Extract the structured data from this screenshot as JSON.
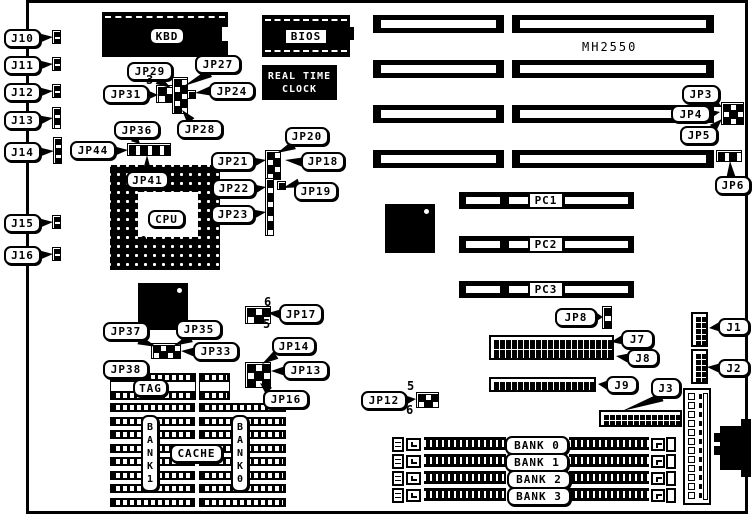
{
  "board_model": "MH2550",
  "colors": {
    "ink": "#000000",
    "paper": "#ffffff"
  },
  "board": {
    "x": 26,
    "y": 0,
    "w": 722,
    "h": 514,
    "border": 3
  },
  "chips": [
    {
      "id": "kbd-chip",
      "x": 102,
      "y": 12,
      "w": 126,
      "h": 45,
      "dash_top": true,
      "notch": [
        222,
        27,
        6,
        14
      ]
    },
    {
      "id": "bios-chip",
      "x": 262,
      "y": 15,
      "w": 88,
      "h": 42,
      "dash_top": true,
      "dash_bottom": true,
      "tab": [
        349,
        27,
        5,
        13
      ]
    },
    {
      "id": "rtc-chip",
      "x": 262,
      "y": 65,
      "w": 75,
      "h": 35,
      "text": [
        "REAL TIME",
        "CLOCK"
      ]
    },
    {
      "id": "chipset-chip",
      "x": 385,
      "y": 204,
      "w": 50,
      "h": 49,
      "dot": [
        424,
        209
      ]
    },
    {
      "id": "cache-ctrl-chip",
      "x": 138,
      "y": 283,
      "w": 50,
      "h": 47,
      "dot": [
        177,
        288
      ]
    }
  ],
  "cpu": {
    "x": 110,
    "y": 165,
    "w": 110,
    "h": 105,
    "inner": [
      138,
      192,
      60,
      45
    ],
    "dot": [
      141,
      236
    ]
  },
  "isa": {
    "rows": [
      15,
      60,
      105,
      150
    ],
    "h": 18,
    "segs": [
      [
        373,
        131
      ],
      [
        512,
        202
      ]
    ]
  },
  "pci": {
    "rows": [
      192,
      236,
      281
    ],
    "x": 459,
    "w": 175,
    "h": 17,
    "stripes": [
      [
        466,
        34
      ],
      [
        509,
        20
      ],
      [
        565,
        63
      ]
    ]
  },
  "simm": {
    "rows": [
      436,
      453,
      470,
      487
    ],
    "bracket_left": [
      392,
      12,
      15
    ],
    "clip_left": [
      406,
      15,
      13
    ],
    "bar1": [
      424,
      82
    ],
    "bar2": [
      569,
      80
    ],
    "clip_right": [
      651,
      14,
      13
    ],
    "bracket_right": [
      666,
      10,
      15
    ]
  },
  "cache": {
    "tag_y": 373,
    "tag_h": 27,
    "tag_pieces": [
      [
        110,
        86
      ],
      [
        199,
        31
      ]
    ],
    "cols": [
      [
        110,
        85
      ],
      [
        199,
        87
      ]
    ],
    "chip_ys": [
      403,
      430,
      457,
      484
    ]
  },
  "pinblocks": [
    {
      "id": "kbd-jumper-left",
      "x": 156,
      "y": 85,
      "cols": 2,
      "rows": 2,
      "cw": 8,
      "ch": 8
    },
    {
      "id": "kbd-jumper-mid",
      "x": 172,
      "y": 77,
      "cols": 2,
      "rows": 5,
      "cw": 7,
      "ch": 7
    },
    {
      "id": "kbd-jumper-nub",
      "x": 187,
      "y": 90,
      "cols": 1,
      "rows": 1,
      "cw": 7,
      "ch": 7
    },
    {
      "id": "jp36-strip",
      "x": 127,
      "y": 143,
      "cols": 7,
      "rows": 1,
      "cw": 6,
      "ch": 11
    },
    {
      "id": "jp18-23-strip-top",
      "x": 265,
      "y": 150,
      "cols": 2,
      "rows": 4,
      "cw": 7,
      "ch": 7
    },
    {
      "id": "jp18-23-strip-bottom",
      "x": 265,
      "y": 178,
      "cols": 1,
      "rows": 8,
      "cw": 7,
      "ch": 7
    },
    {
      "id": "jp19-pin",
      "x": 277,
      "y": 181,
      "cols": 1,
      "rows": 1,
      "cw": 7,
      "ch": 7
    },
    {
      "id": "jp3-5-block",
      "x": 721,
      "y": 102,
      "cols": 3,
      "rows": 3,
      "cw": 7,
      "ch": 7
    },
    {
      "id": "jp6-block",
      "x": 716,
      "y": 150,
      "cols": 4,
      "rows": 1,
      "cw": 6,
      "ch": 10
    },
    {
      "id": "jp8-block",
      "x": 602,
      "y": 306,
      "cols": 1,
      "rows": 3,
      "cw": 8,
      "ch": 7
    },
    {
      "id": "jp17-block",
      "x": 245,
      "y": 306,
      "cols": 3,
      "rows": 2,
      "cw": 8,
      "ch": 8
    },
    {
      "id": "jp13-16-block",
      "x": 245,
      "y": 362,
      "cols": 3,
      "rows": 3,
      "cw": 8,
      "ch": 8
    },
    {
      "id": "jp33-block",
      "x": 151,
      "y": 343,
      "cols": 4,
      "rows": 2,
      "cw": 7,
      "ch": 7
    },
    {
      "id": "jp12-block",
      "x": 416,
      "y": 392,
      "cols": 3,
      "rows": 2,
      "cw": 7,
      "ch": 7
    },
    {
      "id": "j10-conn",
      "x": 52,
      "y": 30,
      "cols": 1,
      "rows": 3,
      "cw": 7,
      "ch": 4
    },
    {
      "id": "j11-conn",
      "x": 52,
      "y": 57,
      "cols": 1,
      "rows": 3,
      "cw": 7,
      "ch": 4
    },
    {
      "id": "j12-conn",
      "x": 52,
      "y": 84,
      "cols": 1,
      "rows": 3,
      "cw": 7,
      "ch": 4
    },
    {
      "id": "j13-conn",
      "x": 52,
      "y": 107,
      "cols": 1,
      "rows": 4,
      "cw": 7,
      "ch": 5
    },
    {
      "id": "j14-conn",
      "x": 53,
      "y": 137,
      "cols": 1,
      "rows": 5,
      "cw": 7,
      "ch": 5
    },
    {
      "id": "j15-conn",
      "x": 52,
      "y": 215,
      "cols": 1,
      "rows": 3,
      "cw": 7,
      "ch": 4
    },
    {
      "id": "j16-conn",
      "x": 52,
      "y": 247,
      "cols": 1,
      "rows": 3,
      "cw": 7,
      "ch": 4
    }
  ],
  "headers": [
    {
      "id": "j7-j8-header",
      "x": 489,
      "y": 335,
      "cols": 20,
      "rows": 2,
      "cw": 5,
      "ch": 9,
      "gap": 1
    },
    {
      "id": "j9-header",
      "x": 489,
      "y": 377,
      "cols": 17,
      "rows": 1,
      "cw": 5,
      "ch": 9,
      "gap": 1
    },
    {
      "id": "j3-header",
      "x": 599,
      "y": 410,
      "cols": 13,
      "rows": 2,
      "cw": 5,
      "ch": 5,
      "gap": 1
    },
    {
      "id": "j1-header",
      "x": 691,
      "y": 312,
      "cols": 2,
      "rows": 5,
      "cw": 5,
      "ch": 5,
      "gap": 1
    },
    {
      "id": "j2-header",
      "x": 691,
      "y": 349,
      "cols": 2,
      "rows": 5,
      "cw": 5,
      "ch": 5,
      "gap": 1
    }
  ],
  "power": {
    "x": 683,
    "y": 388,
    "w": 28,
    "h": 117,
    "pins": 12
  },
  "din": [
    [
      714,
      433,
      8,
      9
    ],
    [
      714,
      446,
      8,
      9
    ],
    [
      720,
      426,
      28,
      44
    ],
    [
      741,
      419,
      10,
      58
    ]
  ],
  "callouts": [
    {
      "id": "j10",
      "label": "J10",
      "x": 4,
      "y": 29,
      "w": 37,
      "h": 19,
      "tail": {
        "from": [
          40,
          38
        ],
        "to": [
          53,
          37
        ]
      }
    },
    {
      "id": "j11",
      "label": "J11",
      "x": 4,
      "y": 56,
      "w": 37,
      "h": 19,
      "tail": {
        "from": [
          40,
          65
        ],
        "to": [
          53,
          64
        ]
      }
    },
    {
      "id": "j12",
      "label": "J12",
      "x": 4,
      "y": 83,
      "w": 37,
      "h": 19,
      "tail": {
        "from": [
          40,
          92
        ],
        "to": [
          53,
          91
        ]
      }
    },
    {
      "id": "j13",
      "label": "J13",
      "x": 4,
      "y": 111,
      "w": 37,
      "h": 19,
      "tail": {
        "from": [
          40,
          120
        ],
        "to": [
          53,
          118
        ]
      }
    },
    {
      "id": "j14",
      "label": "J14",
      "x": 4,
      "y": 142,
      "w": 37,
      "h": 20,
      "tail": {
        "from": [
          40,
          152
        ],
        "to": [
          54,
          151
        ]
      }
    },
    {
      "id": "j15",
      "label": "J15",
      "x": 4,
      "y": 214,
      "w": 37,
      "h": 19,
      "tail": {
        "from": [
          40,
          223
        ],
        "to": [
          53,
          222
        ]
      }
    },
    {
      "id": "j16",
      "label": "J16",
      "x": 4,
      "y": 246,
      "w": 37,
      "h": 19,
      "tail": {
        "from": [
          40,
          255
        ],
        "to": [
          53,
          254
        ]
      }
    },
    {
      "id": "jp29",
      "label": "JP29",
      "x": 127,
      "y": 62,
      "w": 46,
      "h": 19,
      "tail": {
        "from": [
          158,
          80
        ],
        "to": [
          171,
          88
        ]
      }
    },
    {
      "id": "jp27",
      "label": "JP27",
      "x": 195,
      "y": 55,
      "w": 46,
      "h": 19,
      "tail": {
        "from": [
          210,
          73
        ],
        "to": [
          184,
          86
        ]
      }
    },
    {
      "id": "jp24",
      "label": "JP24",
      "x": 209,
      "y": 82,
      "w": 46,
      "h": 18,
      "tail": {
        "from": [
          210,
          91
        ],
        "to": [
          195,
          93
        ]
      }
    },
    {
      "id": "jp31",
      "label": "JP31",
      "x": 103,
      "y": 85,
      "w": 46,
      "h": 19,
      "tail": {
        "from": [
          148,
          95
        ],
        "to": [
          158,
          95
        ]
      }
    },
    {
      "id": "jp28",
      "label": "JP28",
      "x": 177,
      "y": 120,
      "w": 46,
      "h": 19,
      "tail": {
        "from": [
          191,
          121
        ],
        "to": [
          182,
          110
        ]
      }
    },
    {
      "id": "jp36",
      "label": "JP36",
      "x": 114,
      "y": 121,
      "w": 46,
      "h": 18,
      "tail": {
        "from": [
          134,
          138
        ],
        "to": [
          140,
          144
        ]
      }
    },
    {
      "id": "jp44",
      "label": "JP44",
      "x": 70,
      "y": 141,
      "w": 46,
      "h": 19,
      "tail": {
        "from": [
          115,
          151
        ],
        "to": [
          128,
          150
        ]
      }
    },
    {
      "id": "jp41",
      "label": "JP41",
      "x": 126,
      "y": 171,
      "w": 43,
      "h": 18,
      "tail": {
        "from": [
          147,
          172
        ],
        "to": [
          147,
          155
        ]
      }
    },
    {
      "id": "jp20",
      "label": "JP20",
      "x": 285,
      "y": 127,
      "w": 44,
      "h": 19,
      "tail": {
        "from": [
          294,
          145
        ],
        "to": [
          277,
          153
        ]
      }
    },
    {
      "id": "jp21",
      "label": "JP21",
      "x": 211,
      "y": 152,
      "w": 44,
      "h": 19,
      "tail": {
        "from": [
          254,
          162
        ],
        "to": [
          266,
          160
        ]
      }
    },
    {
      "id": "jp18",
      "label": "JP18",
      "x": 301,
      "y": 152,
      "w": 44,
      "h": 19,
      "tail": {
        "from": [
          302,
          162
        ],
        "to": [
          285,
          160
        ]
      }
    },
    {
      "id": "jp22",
      "label": "JP22",
      "x": 212,
      "y": 179,
      "w": 44,
      "h": 19,
      "tail": {
        "from": [
          255,
          189
        ],
        "to": [
          266,
          187
        ]
      }
    },
    {
      "id": "jp19",
      "label": "JP19",
      "x": 294,
      "y": 182,
      "w": 44,
      "h": 19,
      "tail": {
        "from": [
          299,
          183
        ],
        "to": [
          283,
          188
        ]
      }
    },
    {
      "id": "jp23",
      "label": "JP23",
      "x": 211,
      "y": 205,
      "w": 44,
      "h": 19,
      "tail": {
        "from": [
          254,
          214
        ],
        "to": [
          266,
          212
        ]
      }
    },
    {
      "id": "jp3",
      "label": "JP3",
      "x": 682,
      "y": 85,
      "w": 38,
      "h": 19,
      "tail": {
        "from": [
          714,
          103
        ],
        "to": [
          722,
          107
        ]
      }
    },
    {
      "id": "jp4",
      "label": "JP4",
      "x": 671,
      "y": 105,
      "w": 40,
      "h": 18,
      "tail": {
        "from": [
          710,
          114
        ],
        "to": [
          720,
          112
        ]
      }
    },
    {
      "id": "jp5",
      "label": "JP5",
      "x": 680,
      "y": 126,
      "w": 38,
      "h": 19,
      "tail": {
        "from": [
          713,
          128
        ],
        "to": [
          722,
          119
        ]
      }
    },
    {
      "id": "jp6",
      "label": "JP6",
      "x": 715,
      "y": 176,
      "w": 36,
      "h": 19,
      "tail": {
        "from": [
          731,
          177
        ],
        "to": [
          730,
          161
        ]
      }
    },
    {
      "id": "jp8",
      "label": "JP8",
      "x": 555,
      "y": 308,
      "w": 42,
      "h": 19,
      "tail": {
        "from": [
          596,
          317
        ],
        "to": [
          603,
          317
        ]
      }
    },
    {
      "id": "j7",
      "label": "J7",
      "x": 621,
      "y": 330,
      "w": 33,
      "h": 19,
      "tail": {
        "from": [
          622,
          340
        ],
        "to": [
          611,
          342
        ]
      }
    },
    {
      "id": "j8",
      "label": "J8",
      "x": 627,
      "y": 349,
      "w": 32,
      "h": 18,
      "tail": {
        "from": [
          628,
          358
        ],
        "to": [
          616,
          356
        ]
      }
    },
    {
      "id": "j9",
      "label": "J9",
      "x": 606,
      "y": 376,
      "w": 32,
      "h": 18,
      "tail": {
        "from": [
          607,
          385
        ],
        "to": [
          598,
          384
        ]
      }
    },
    {
      "id": "j3",
      "label": "J3",
      "x": 651,
      "y": 378,
      "w": 30,
      "h": 20,
      "tail": {
        "from": [
          662,
          397
        ],
        "to": [
          622,
          411
        ]
      }
    },
    {
      "id": "j1",
      "label": "J1",
      "x": 718,
      "y": 318,
      "w": 32,
      "h": 18,
      "tail": {
        "from": [
          719,
          327
        ],
        "to": [
          709,
          328
        ]
      }
    },
    {
      "id": "j2",
      "label": "J2",
      "x": 718,
      "y": 359,
      "w": 32,
      "h": 18,
      "tail": {
        "from": [
          719,
          368
        ],
        "to": [
          707,
          367
        ]
      }
    },
    {
      "id": "jp37",
      "label": "JP37",
      "x": 103,
      "y": 322,
      "w": 46,
      "h": 19,
      "tail": {
        "from": [
          139,
          340
        ],
        "to": [
          157,
          347
        ]
      }
    },
    {
      "id": "jp35",
      "label": "JP35",
      "x": 176,
      "y": 320,
      "w": 46,
      "h": 19,
      "tail": {
        "from": [
          191,
          338
        ],
        "to": [
          173,
          346
        ]
      }
    },
    {
      "id": "jp33",
      "label": "JP33",
      "x": 193,
      "y": 342,
      "w": 46,
      "h": 19,
      "tail": {
        "from": [
          194,
          352
        ],
        "to": [
          181,
          351
        ]
      }
    },
    {
      "id": "jp38",
      "label": "JP38",
      "x": 103,
      "y": 360,
      "w": 46,
      "h": 19,
      "tail": {
        "from": [
          144,
          378
        ],
        "to": [
          153,
          380
        ]
      }
    },
    {
      "id": "tag",
      "label": "TAG",
      "x": 133,
      "y": 379,
      "w": 35,
      "h": 18
    },
    {
      "id": "cache",
      "label": "CACHE",
      "x": 170,
      "y": 444,
      "w": 53,
      "h": 19
    },
    {
      "id": "bank1-cache",
      "label": "BANK1",
      "x": 141,
      "y": 415,
      "w": 18,
      "h": 77,
      "vertical": true
    },
    {
      "id": "bank0-cache",
      "label": "BANK0",
      "x": 231,
      "y": 415,
      "w": 18,
      "h": 77,
      "vertical": true
    },
    {
      "id": "jp17",
      "label": "JP17",
      "x": 279,
      "y": 304,
      "w": 44,
      "h": 20,
      "tail": {
        "from": [
          280,
          314
        ],
        "to": [
          268,
          313
        ]
      }
    },
    {
      "id": "jp14",
      "label": "JP14",
      "x": 272,
      "y": 337,
      "w": 44,
      "h": 18,
      "tail": {
        "from": [
          276,
          355
        ],
        "to": [
          262,
          364
        ]
      }
    },
    {
      "id": "jp13",
      "label": "JP13",
      "x": 283,
      "y": 361,
      "w": 46,
      "h": 19,
      "tail": {
        "from": [
          284,
          371
        ],
        "to": [
          271,
          371
        ]
      }
    },
    {
      "id": "jp16",
      "label": "JP16",
      "x": 263,
      "y": 390,
      "w": 46,
      "h": 19,
      "tail": {
        "from": [
          269,
          391
        ],
        "to": [
          260,
          383
        ]
      }
    },
    {
      "id": "jp12",
      "label": "JP12",
      "x": 361,
      "y": 391,
      "w": 46,
      "h": 19,
      "tail": {
        "from": [
          406,
          400
        ],
        "to": [
          416,
          399
        ]
      }
    },
    {
      "id": "bank0-simm",
      "label": "BANK 0",
      "x": 505,
      "y": 436,
      "w": 64,
      "h": 19
    },
    {
      "id": "bank1-simm",
      "label": "BANK 1",
      "x": 505,
      "y": 453,
      "w": 64,
      "h": 19
    },
    {
      "id": "bank2-simm",
      "label": "BANK 2",
      "x": 507,
      "y": 470,
      "w": 64,
      "h": 19
    },
    {
      "id": "bank3-simm",
      "label": "BANK 3",
      "x": 507,
      "y": 487,
      "w": 64,
      "h": 19
    },
    {
      "id": "pc1",
      "label": "PC1",
      "x": 528,
      "y": 192,
      "w": 36,
      "h": 17,
      "square": true
    },
    {
      "id": "pc2",
      "label": "PC2",
      "x": 528,
      "y": 236,
      "w": 36,
      "h": 17,
      "square": true
    },
    {
      "id": "pc3",
      "label": "PC3",
      "x": 528,
      "y": 281,
      "w": 36,
      "h": 17,
      "square": true
    },
    {
      "id": "kbd",
      "label": "KBD",
      "x": 149,
      "y": 27,
      "w": 36,
      "h": 18
    },
    {
      "id": "bios",
      "label": "BIOS",
      "x": 284,
      "y": 28,
      "w": 44,
      "h": 17,
      "square": true
    },
    {
      "id": "cpu",
      "label": "CPU",
      "x": 148,
      "y": 210,
      "w": 37,
      "h": 18
    }
  ],
  "numbers": [
    {
      "id": "pin3-kbd-jumper",
      "label": "3",
      "x": 146,
      "y": 73
    },
    {
      "id": "pin6-jp17",
      "label": "6",
      "x": 264,
      "y": 295
    },
    {
      "id": "pin5-jp17",
      "label": "5",
      "x": 263,
      "y": 317
    },
    {
      "id": "pin5-jp12",
      "label": "5",
      "x": 407,
      "y": 379
    },
    {
      "id": "pin6-jp12",
      "label": "6",
      "x": 406,
      "y": 403
    }
  ]
}
